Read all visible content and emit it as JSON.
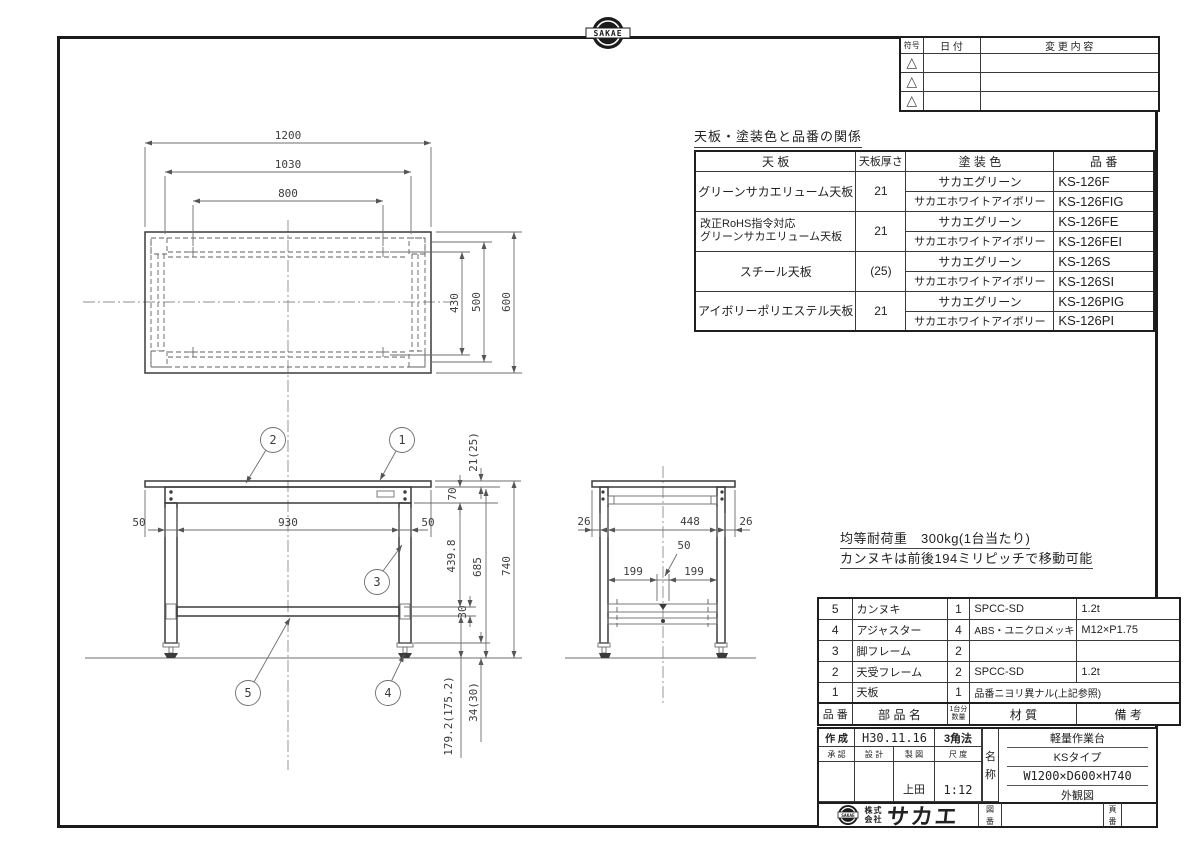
{
  "brand": {
    "top_logo_text": "SAKAE",
    "bottom_logo_text": "SAKAE"
  },
  "revision_table": {
    "symbol_header": "符号",
    "date_header": "日 付",
    "change_header": "変 更 内 容",
    "triangle_symbol": "△"
  },
  "finish_table": {
    "title": "天板・塗装色と品番の関係",
    "headers": {
      "top": "天 板",
      "thickness": "天板厚さ",
      "color": "塗 装 色",
      "part_no": "品 番"
    },
    "groups": [
      {
        "top": "グリーンサカエリューム天板",
        "top_line2": "",
        "thickness": "21",
        "rows": [
          {
            "color": "サカエグリーン",
            "part": "KS-126F"
          },
          {
            "color": "サカエホワイトアイボリー",
            "part": "KS-126FIG"
          }
        ]
      },
      {
        "top": "改正RoHS指令対応",
        "top_line2": "グリーンサカエリューム天板",
        "thickness": "21",
        "rows": [
          {
            "color": "サカエグリーン",
            "part": "KS-126FE"
          },
          {
            "color": "サカエホワイトアイボリー",
            "part": "KS-126FEI"
          }
        ]
      },
      {
        "top": "スチール天板",
        "top_line2": "",
        "thickness": "(25)",
        "rows": [
          {
            "color": "サカエグリーン",
            "part": "KS-126S"
          },
          {
            "color": "サカエホワイトアイボリー",
            "part": "KS-126SI"
          }
        ]
      },
      {
        "top": "アイボリーポリエステル天板",
        "top_line2": "",
        "thickness": "21",
        "rows": [
          {
            "color": "サカエグリーン",
            "part": "KS-126PIG"
          },
          {
            "color": "サカエホワイトアイボリー",
            "part": "KS-126PI"
          }
        ]
      }
    ]
  },
  "notes": {
    "line1": "均等耐荷重　300kg(1台当たり)",
    "line2": "カンヌキは前後194ミリピッチで移動可能"
  },
  "parts_table": {
    "headers": {
      "no": "品 番",
      "name": "部 品 名",
      "qty_top": "1台分",
      "qty_bottom": "数量",
      "material": "材  質",
      "remarks": "備  考"
    },
    "rows": [
      {
        "no": "5",
        "name": "カンヌキ",
        "qty": "1",
        "material": "SPCC-SD",
        "remarks": "1.2t"
      },
      {
        "no": "4",
        "name": "アジャスター",
        "qty": "4",
        "material": "ABS・ユニクロメッキ",
        "remarks": "M12×P1.75"
      },
      {
        "no": "3",
        "name": "脚フレーム",
        "qty": "2",
        "material": "",
        "remarks": ""
      },
      {
        "no": "2",
        "name": "天受フレーム",
        "qty": "2",
        "material": "SPCC-SD",
        "remarks": "1.2t"
      },
      {
        "no": "1",
        "name": "天板",
        "qty": "1",
        "material": "品番ニヨリ異ナル(上記参照)",
        "remarks": ""
      }
    ]
  },
  "title_block": {
    "created_label": "作 成",
    "created_date": "H30.11.16",
    "projection": "3角法",
    "approved_label": "承 認",
    "design_label": "設 計",
    "draft_label": "製 図",
    "scale_label": "尺 度",
    "drafter": "上田",
    "scale": "1:12",
    "name_label_top": "名",
    "name_label_bottom": "称",
    "product_name": "軽量作業台",
    "product_type": "KSタイプ",
    "product_size": "W1200×D600×H740",
    "drawing_type": "外観図",
    "company_prefix_top": "株式",
    "company_prefix_bottom": "会社",
    "company_name": "サカエ",
    "drawing_no_label_top": "図",
    "drawing_no_label_bottom": "番",
    "page_no_label_top": "頁",
    "page_no_label_bottom": "番"
  },
  "drawing": {
    "plan": {
      "d1200": "1200",
      "d1030": "1030",
      "d800": "800",
      "d430": "430",
      "d500": "500",
      "d600": "600"
    },
    "front": {
      "d50L": "50",
      "d930": "930",
      "d50R": "50",
      "d21": "21(25)",
      "d70": "70",
      "d4398": "439.8",
      "d685": "685",
      "d740": "740",
      "d30": "30",
      "d1792": "179.2(175.2)",
      "d34": "34(30)",
      "b1": "1",
      "b2": "2",
      "b3": "3",
      "b4": "4",
      "b5": "5"
    },
    "side": {
      "d26L": "26",
      "d448": "448",
      "d26R": "26",
      "d50": "50",
      "d199L": "199",
      "d199R": "199"
    }
  }
}
